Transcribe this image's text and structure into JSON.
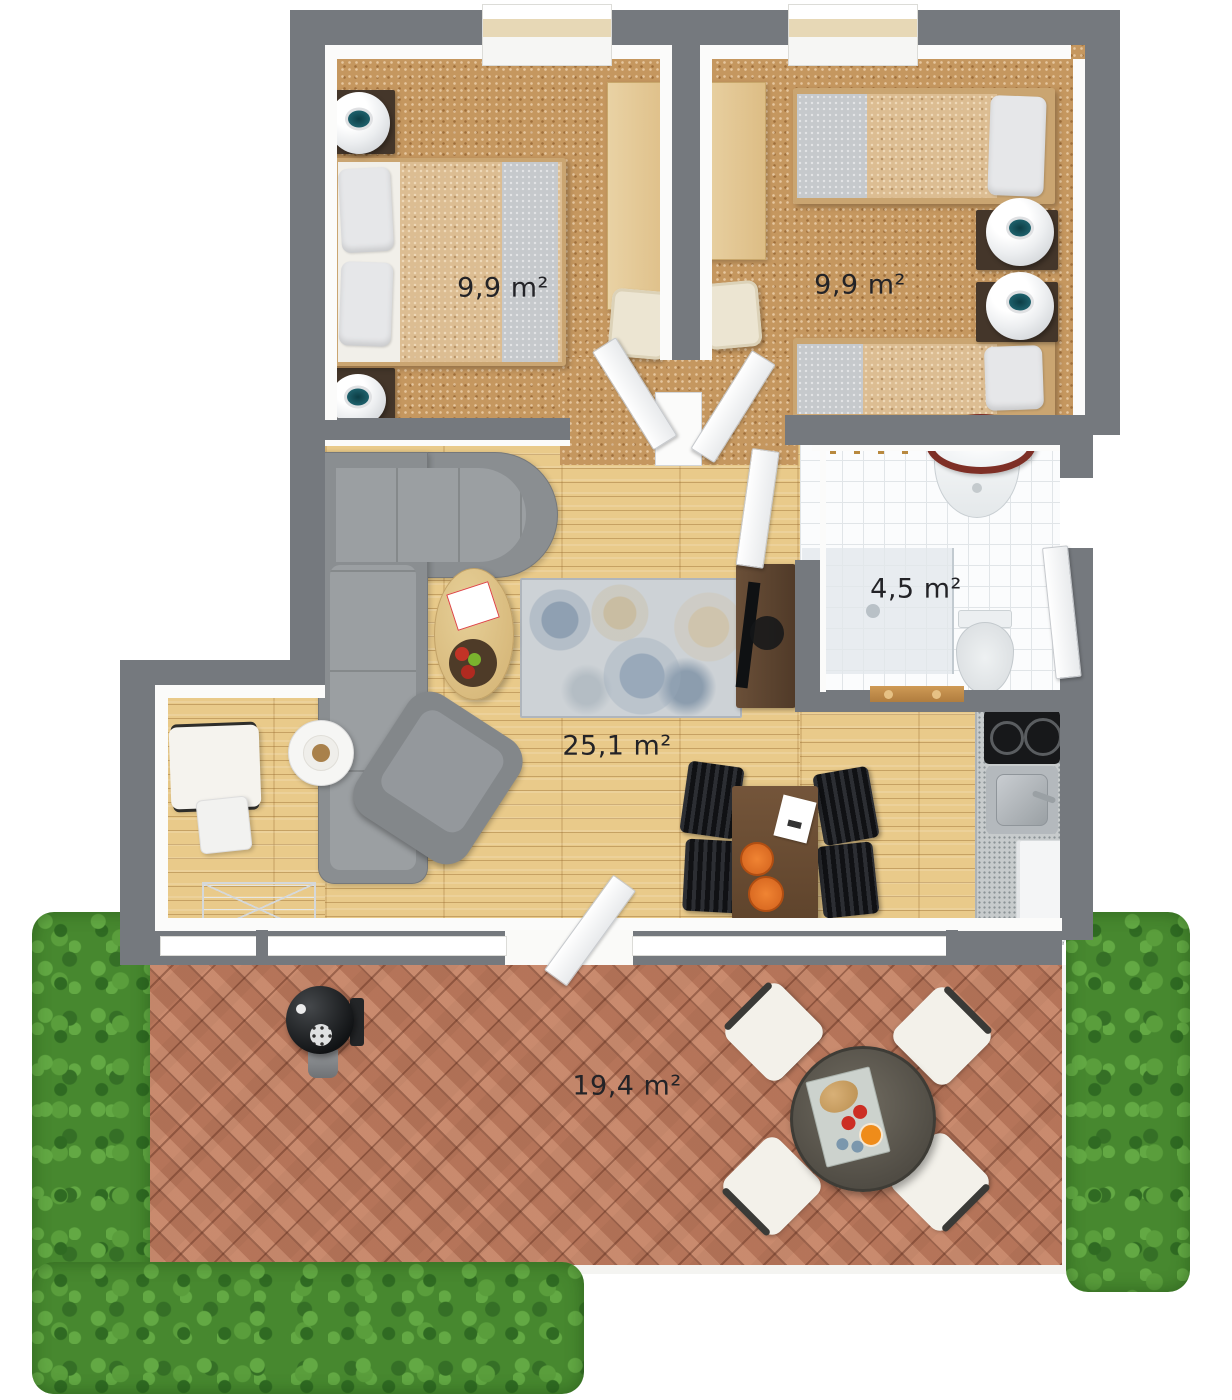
{
  "rooms": [
    {
      "name": "bedroom-left",
      "area_label": "9,9 m²"
    },
    {
      "name": "bedroom-right",
      "area_label": "9,9 m²"
    },
    {
      "name": "bathroom",
      "area_label": "4,5 m²"
    },
    {
      "name": "living-room",
      "area_label": "25,1 m²"
    },
    {
      "name": "terrace",
      "area_label": "19,4 m²"
    }
  ],
  "furniture": {
    "bedroom_left": [
      "double-bed",
      "nightstand",
      "table-lamp",
      "nightstand",
      "table-lamp",
      "desk",
      "desk-chair"
    ],
    "bedroom_right": [
      "single-bed",
      "single-bed",
      "nightstand",
      "table-lamp",
      "nightstand",
      "table-lamp",
      "desk",
      "desk-chair"
    ],
    "bathroom": [
      "shower",
      "wash-basin",
      "mirror",
      "toilet",
      "towel-rack"
    ],
    "living_room": [
      "corner-sofa",
      "armchair",
      "coffee-table",
      "fruit-bowl",
      "area-rug",
      "tv-stand",
      "dining-table",
      "dining-chair",
      "dining-chair",
      "dining-chair",
      "dining-chair",
      "kitchen-counter",
      "cooktop",
      "kitchen-sink",
      "refrigerator",
      "cube-chair",
      "side-table",
      "round-table",
      "wire-rack"
    ],
    "terrace": [
      "bbq-grill",
      "patio-table",
      "serving-tray",
      "patio-chair",
      "patio-chair",
      "patio-chair",
      "patio-chair",
      "hedge",
      "hedge",
      "hedge"
    ]
  },
  "colors": {
    "wall": "#75797e",
    "carpet": "#c5975f",
    "wood_floor": "#e9ca8a",
    "tile": "#fbfcfd",
    "brick": "#bd7e62",
    "hedge": "#47882f",
    "sofa": "#8a8e91"
  }
}
